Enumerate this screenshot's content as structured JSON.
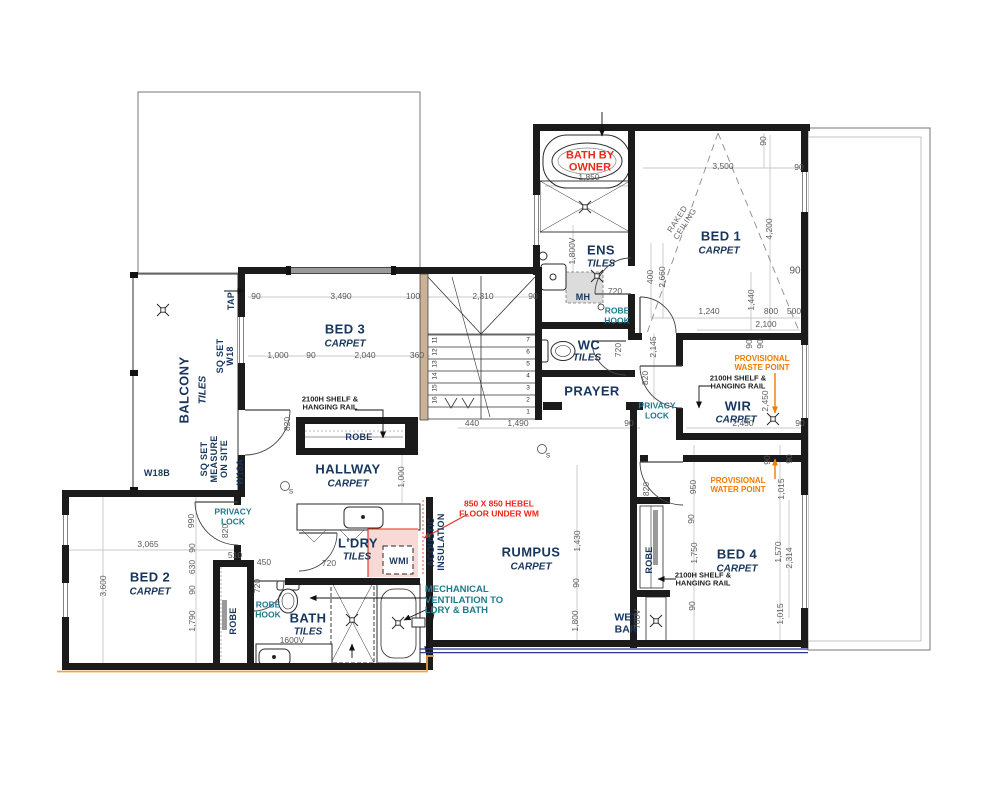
{
  "rooms": {
    "balcony": {
      "name": "BALCONY",
      "finish": "TILES"
    },
    "bed3": {
      "name": "BED 3",
      "finish": "CARPET"
    },
    "bed2": {
      "name": "BED 2",
      "finish": "CARPET"
    },
    "hallway": {
      "name": "HALLWAY",
      "finish": "CARPET"
    },
    "ldry": {
      "name": "L'DRY",
      "finish": "TILES"
    },
    "bath": {
      "name": "BATH",
      "finish": "TILES"
    },
    "rumpus": {
      "name": "RUMPUS",
      "finish": "CARPET"
    },
    "prayer": {
      "name": "PRAYER"
    },
    "wc": {
      "name": "WC",
      "finish": "TILES"
    },
    "ens": {
      "name": "ENS",
      "finish": "TILES"
    },
    "bed1": {
      "name": "BED 1",
      "finish": "CARPET"
    },
    "wir": {
      "name": "WIR",
      "finish": "CARPET"
    },
    "bed4": {
      "name": "BED 4",
      "finish": "CARPET"
    },
    "wetbar": {
      "name": "WET\nBAR"
    }
  },
  "labels": {
    "robe": "ROBE",
    "robe_hook": "ROBE\nHOOK",
    "wmi": "WMI",
    "mh": "MH",
    "tap": "TAP",
    "sq_set_w18": "SQ SET\nW18",
    "sq_set_measure": "SQ SET\nMEASURE\nON SITE",
    "w18b": "W18B",
    "w18a": "W18A",
    "privacy_lock": "PRIVACY\nLOCK",
    "shelf_rail": "2100H SHELF &\nHANGING RAIL",
    "raked_ceiling": "RAKED\nCEILING",
    "smoke": "S"
  },
  "notes": {
    "bath_by_owner": "BATH BY\nOWNER",
    "hebel": "850 X 850 HEBEL\nFLOOR UNDER WM",
    "mech_vent": "MECHANICAL\nVENTILATION TO\nLDRY & BATH",
    "waste": "PROVISIONAL\nWASTE POINT",
    "water": "PROVISIONAL\nWATER POINT",
    "acoustic": "ACOUSTIC\nINSULATION"
  },
  "dims": {
    "d90": "90",
    "d100": "100",
    "d360": "360",
    "d400": "400",
    "d440": "440",
    "d450": "450",
    "d500": "500",
    "d510": "510",
    "d630": "630",
    "d700v": "700V",
    "d720": "720",
    "d800": "800",
    "d820": "820",
    "d950": "950",
    "d990": "990",
    "d1000": "1,000",
    "d1015": "1,015",
    "d1240": "1,240",
    "d1430": "1,430",
    "d1440": "1,440",
    "d1490": "1,490",
    "d1570": "1,570",
    "d1600v": "1600V",
    "d1750": "1,750",
    "d1790": "1,790",
    "d1800": "1,800",
    "d1800v": "1,800V",
    "d1850": "1,850",
    "d2040": "2,040",
    "d2100": "2,100",
    "d2145": "2,145",
    "d2310": "2,310",
    "d2314": "2,314",
    "d2450": "2,450",
    "d2660": "2,660",
    "d3065": "3,065",
    "d3490": "3,490",
    "d3500": "3,500",
    "d3600": "3,600",
    "d4200": "4,200"
  },
  "stairs": {
    "right": [
      "7",
      "6",
      "5",
      "4",
      "3",
      "2",
      "1"
    ],
    "left": [
      "11",
      "12",
      "13",
      "14",
      "15",
      "16"
    ]
  },
  "colors": {
    "wall": "#1b1b1b",
    "room_text": "#17365d",
    "note_red": "#e8291c",
    "note_orange": "#f07c00",
    "note_teal": "#1f7a8c",
    "dim_text": "#5a5a5a",
    "balustrade_blue": "#2b3990",
    "ground_orange": "#f0a24a"
  }
}
